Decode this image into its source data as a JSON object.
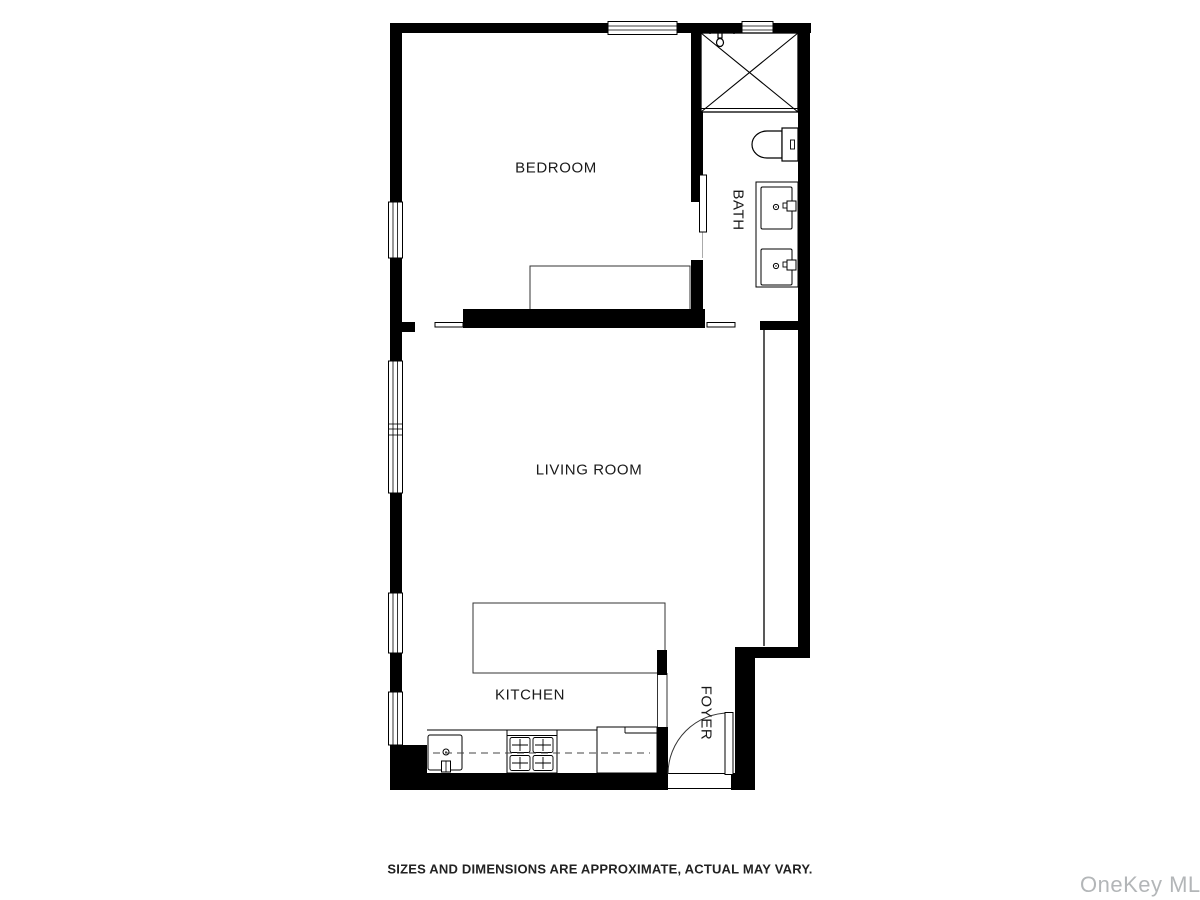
{
  "floor_plan": {
    "rooms": {
      "bedroom": {
        "label": "BEDROOM"
      },
      "bath": {
        "label": "BATH"
      },
      "living_room": {
        "label": "LIVING ROOM"
      },
      "kitchen": {
        "label": "KITCHEN"
      },
      "foyer": {
        "label": "FOYER"
      }
    },
    "fixtures": [
      "shower-with-x",
      "shower-head-icon",
      "toilet",
      "double-vanity-sinks",
      "bed",
      "kitchen-island",
      "kitchen-sink",
      "stove-cooktop",
      "refrigerator",
      "entry-door-swing",
      "bath-sliding-door",
      "wall-windows"
    ],
    "colors": {
      "walls": "#000000",
      "background": "#ffffff",
      "fixture_lines": "#333333"
    }
  },
  "footer": {
    "disclaimer": "SIZES AND DIMENSIONS ARE APPROXIMATE, ACTUAL MAY VARY."
  },
  "watermark": {
    "text": "OneKey MLS",
    "color": "#b3b6b8"
  }
}
